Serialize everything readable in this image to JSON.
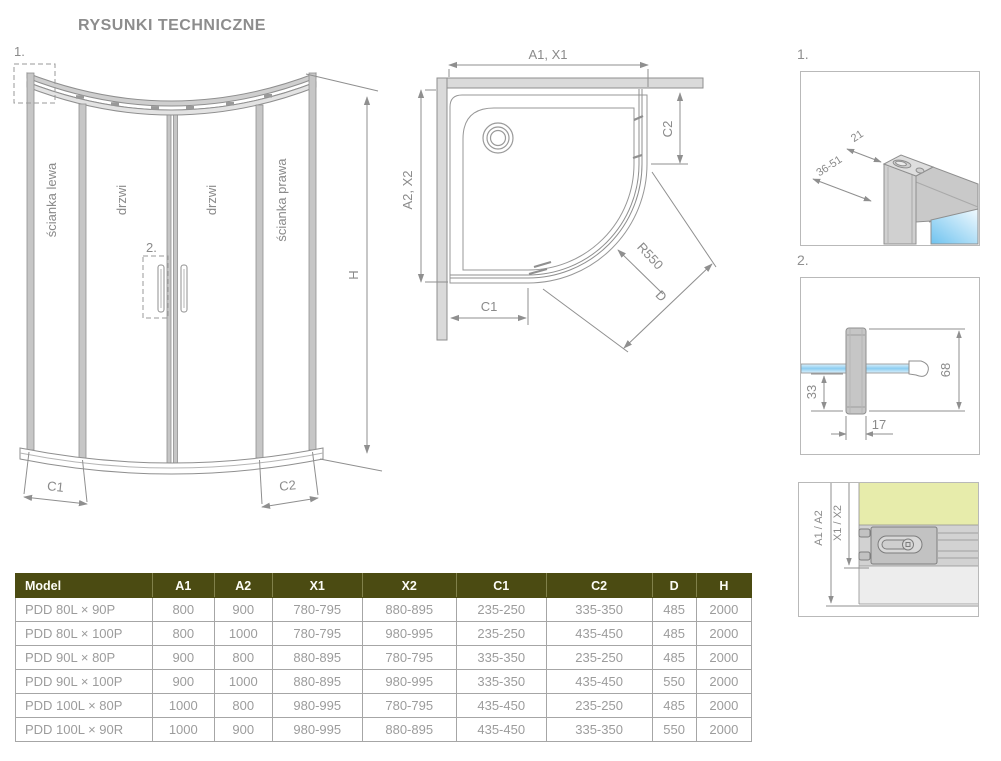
{
  "title": "RYSUNKI TECHNICZNE",
  "front_view": {
    "marker_1": "1.",
    "marker_2": "2.",
    "label_left_wall": "ścianka lewa",
    "label_door_1": "drzwi",
    "label_door_2": "drzwi",
    "label_right_wall": "ścianka prawa",
    "dim_h": "H",
    "dim_c1": "C1",
    "dim_c2": "C2"
  },
  "top_view": {
    "dim_a1_x1": "A1, X1",
    "dim_a2_x2": "A2, X2",
    "dim_c1": "C1",
    "dim_c2": "C2",
    "dim_radius": "R550",
    "dim_d": "D"
  },
  "detail_1": {
    "marker": "1.",
    "dim_depth": "21",
    "dim_range": "36-51"
  },
  "detail_2": {
    "marker": "2.",
    "dim_height": "68",
    "dim_lower": "33",
    "dim_width": "17"
  },
  "detail_3": {
    "dim_outer": "A1 / A2",
    "dim_inner": "X1 / X2"
  },
  "table": {
    "headers": [
      "Model",
      "A1",
      "A2",
      "X1",
      "X2",
      "C1",
      "C2",
      "D",
      "H"
    ],
    "rows": [
      [
        "PDD 80L × 90P",
        "800",
        "900",
        "780-795",
        "880-895",
        "235-250",
        "335-350",
        "485",
        "2000"
      ],
      [
        "PDD 80L × 100P",
        "800",
        "1000",
        "780-795",
        "980-995",
        "235-250",
        "435-450",
        "485",
        "2000"
      ],
      [
        "PDD 90L × 80P",
        "900",
        "800",
        "880-895",
        "780-795",
        "335-350",
        "235-250",
        "485",
        "2000"
      ],
      [
        "PDD 90L × 100P",
        "900",
        "1000",
        "880-895",
        "980-995",
        "335-350",
        "435-450",
        "550",
        "2000"
      ],
      [
        "PDD 100L × 80P",
        "1000",
        "800",
        "980-995",
        "780-795",
        "435-450",
        "235-250",
        "485",
        "2000"
      ],
      [
        "PDD 100L × 90R",
        "1000",
        "900",
        "980-995",
        "880-895",
        "435-450",
        "335-350",
        "550",
        "2000"
      ]
    ]
  },
  "colors": {
    "table_header_bg": "#4b4b12",
    "drawing_line": "#8f8f8f",
    "wall_fill": "#e7ecab",
    "glass_blue": "#7ec9f0"
  }
}
